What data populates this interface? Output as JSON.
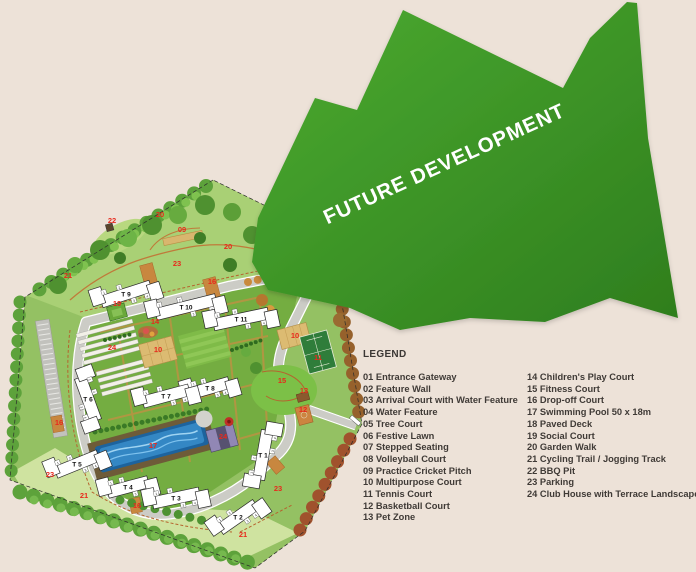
{
  "colors": {
    "background": "#ede2d8",
    "arrow_green_light": "#4cab31",
    "arrow_green_dark": "#2e7d1d",
    "marker_red": "#e8291c"
  },
  "future_development": {
    "label": "FUTURE DEVELOPMENT"
  },
  "legend": {
    "title": "LEGEND",
    "col1": [
      "01 Entrance Gateway",
      "02 Feature Wall",
      "03 Arrival Court with Water Feature",
      "04 Water Feature",
      "05 Tree Court",
      "06 Festive Lawn",
      "07 Stepped Seating",
      "08 Volleyball Court",
      "09 Practice Cricket Pitch",
      "10 Multipurpose Court",
      "11 Tennis Court",
      "12 Basketball Court",
      "13 Pet Zone"
    ],
    "col2": [
      "14 Children's Play Court",
      "15 Fitness Court",
      "16 Drop-off Court",
      "17 Swimming Pool 50 x 18m",
      "18 Paved Deck",
      "19 Social Court",
      "20 Garden Walk",
      "21 Cycling Trail / Jogging Track",
      "22 BBQ Pit",
      "23 Parking",
      "24 Club House with Terrace Landscape"
    ]
  },
  "map": {
    "unit_numbers": [
      "1",
      "2",
      "3",
      "4",
      "5",
      "6"
    ],
    "towers": [
      {
        "label": "T 9",
        "x": 126,
        "y": 294,
        "rot": -18,
        "len": 52
      },
      {
        "label": "T 10",
        "x": 186,
        "y": 307,
        "rot": -14,
        "len": 62
      },
      {
        "label": "T 11",
        "x": 241,
        "y": 319,
        "rot": -12,
        "len": 56
      },
      {
        "label": "T 8",
        "x": 210,
        "y": 388,
        "rot": -16,
        "len": 40
      },
      {
        "label": "T 7",
        "x": 166,
        "y": 396,
        "rot": -15,
        "len": 48
      },
      {
        "label": "T 6",
        "x": 88,
        "y": 399,
        "rot": 70,
        "len": 46
      },
      {
        "label": "T 5",
        "x": 77,
        "y": 464,
        "rot": -22,
        "len": 46
      },
      {
        "label": "T 4",
        "x": 128,
        "y": 487,
        "rot": -15,
        "len": 42
      },
      {
        "label": "T 3",
        "x": 176,
        "y": 498,
        "rot": -12,
        "len": 48
      },
      {
        "label": "T 2",
        "x": 238,
        "y": 517,
        "rot": -35,
        "len": 44
      },
      {
        "label": "T 1",
        "x": 263,
        "y": 455,
        "rot": -80,
        "len": 50
      }
    ],
    "markers": [
      {
        "n": "21",
        "x": 68,
        "y": 278
      },
      {
        "n": "22",
        "x": 112,
        "y": 223
      },
      {
        "n": "20",
        "x": 160,
        "y": 217
      },
      {
        "n": "09",
        "x": 182,
        "y": 232
      },
      {
        "n": "20",
        "x": 228,
        "y": 249
      },
      {
        "n": "23",
        "x": 177,
        "y": 266
      },
      {
        "n": "16",
        "x": 212,
        "y": 284
      },
      {
        "n": "19",
        "x": 117,
        "y": 306
      },
      {
        "n": "14",
        "x": 155,
        "y": 324
      },
      {
        "n": "24",
        "x": 112,
        "y": 350
      },
      {
        "n": "10",
        "x": 158,
        "y": 352
      },
      {
        "n": "10",
        "x": 295,
        "y": 338
      },
      {
        "n": "11",
        "x": 318,
        "y": 360
      },
      {
        "n": "15",
        "x": 282,
        "y": 383
      },
      {
        "n": "13",
        "x": 304,
        "y": 393
      },
      {
        "n": "12",
        "x": 303,
        "y": 412
      },
      {
        "n": "16",
        "x": 59,
        "y": 425
      },
      {
        "n": "23",
        "x": 50,
        "y": 477
      },
      {
        "n": "17",
        "x": 153,
        "y": 448
      },
      {
        "n": "24",
        "x": 223,
        "y": 439
      },
      {
        "n": "21",
        "x": 84,
        "y": 498
      },
      {
        "n": "16",
        "x": 137,
        "y": 508
      },
      {
        "n": "21",
        "x": 243,
        "y": 537
      },
      {
        "n": "23",
        "x": 278,
        "y": 491
      }
    ]
  }
}
